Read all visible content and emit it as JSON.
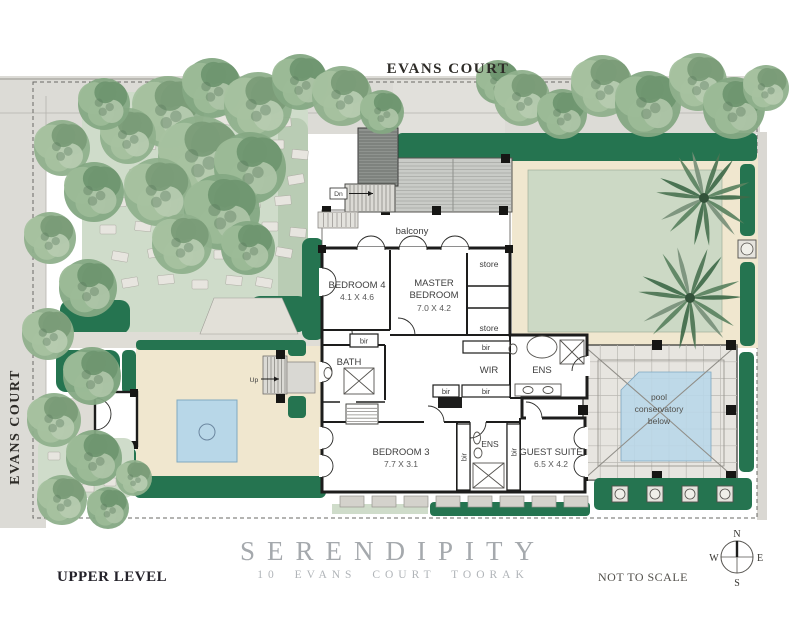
{
  "streets": {
    "top": "EVANS COURT",
    "left": "EVANS COURT"
  },
  "plan": {
    "balcony_label": "balcony",
    "stair_down_label": "Dn",
    "stair_up_label": "Up",
    "rooms": {
      "bedroom4": {
        "name": "BEDROOM 4",
        "dims": "4.1 X 4.6"
      },
      "master": {
        "name_line1": "MASTER",
        "name_line2": "BEDROOM",
        "dims": "7.0 X 4.2"
      },
      "bedroom3": {
        "name": "BEDROOM 3",
        "dims": "7.7 X 3.1"
      },
      "guest_suite": {
        "name": "GUEST SUITE",
        "dims": "6.5 X 4.2"
      },
      "bath": "BATH",
      "wir": "WIR",
      "ens_master": "ENS",
      "ens_guest": "ENS"
    },
    "storage": {
      "store_upper": "store",
      "store_lower": "store",
      "built_in_robe": "bir"
    },
    "pool_note": {
      "line1": "pool",
      "line2": "conservatory",
      "line3": "below"
    }
  },
  "title_block": {
    "title": "SERENDIPITY",
    "subtitle": "10 EVANS COURT TOORAK",
    "level": "UPPER LEVEL",
    "scale_note": "NOT TO SCALE"
  },
  "compass": {
    "north": "N",
    "south": "S",
    "east": "E",
    "west": "W"
  },
  "colors": {
    "hedge_green": "#257450",
    "lawn_green": "#cfdcca",
    "paving_cream": "#f0e7cf",
    "water_blue": "#b8d7e8",
    "street_grey": "#dcdbd6",
    "wall_black": "#1d1d1c",
    "title_grey": "#a5a9ad"
  }
}
